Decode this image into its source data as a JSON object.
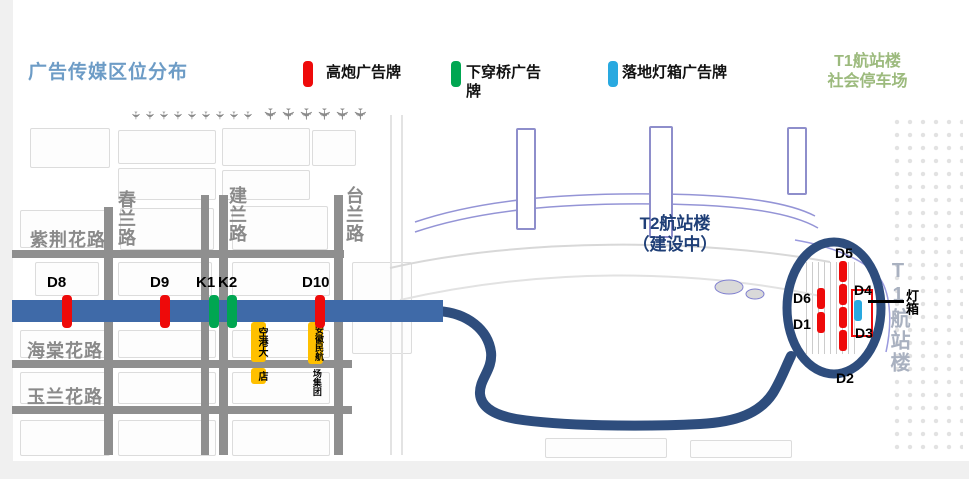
{
  "title": "广告传媒区位分布",
  "legend": {
    "items": [
      {
        "label": "高炮广告牌",
        "color": "#ee0a0a"
      },
      {
        "label": "下穿桥广告牌",
        "color": "#00a651"
      },
      {
        "label": "落地灯箱广告牌",
        "color": "#29a9e0"
      }
    ],
    "parking_line1": "T1航站楼",
    "parking_line2": "社会停车场",
    "parking_color": "#9cba7d"
  },
  "colors": {
    "title_blue": "#6d9cc6",
    "main_road": "#3f6aa8",
    "loop_road": "#2e4d7d",
    "billboard_red": "#ee0a0a",
    "underpass_green": "#00a651",
    "lightbox_cyan": "#29a9e0",
    "poi_yellow": "#ffc000",
    "t2_text": "#1f3f77",
    "t1_text": "#a9b1c0"
  },
  "map": {
    "road_labels_h": [
      "紫荆花路",
      "海棠花路",
      "玉兰花路"
    ],
    "road_labels_v": [
      "春兰路",
      "建兰路",
      "台兰路"
    ],
    "main_markers": [
      {
        "id": "D8",
        "color": "#ee0a0a"
      },
      {
        "id": "D9",
        "color": "#ee0a0a"
      },
      {
        "id": "K1",
        "color": "#00a651"
      },
      {
        "id": "K2",
        "color": "#00a651"
      },
      {
        "id": "D10",
        "color": "#ee0a0a"
      }
    ],
    "t2_line1": "T2航站楼",
    "t2_line2": "（建设中）",
    "t1_vertical": "T1航站楼",
    "lightbox_pointer_label": "灯箱",
    "poi_hotel_top": "空港大",
    "poi_hotel_bottom": "店",
    "poi_group_top": "安徽民航",
    "poi_group_bottom": "场集团",
    "t1_markers": [
      {
        "id": "D5"
      },
      {
        "id": "D6"
      },
      {
        "id": "D1"
      },
      {
        "id": "D4"
      },
      {
        "id": "D3"
      },
      {
        "id": "D2"
      }
    ]
  }
}
